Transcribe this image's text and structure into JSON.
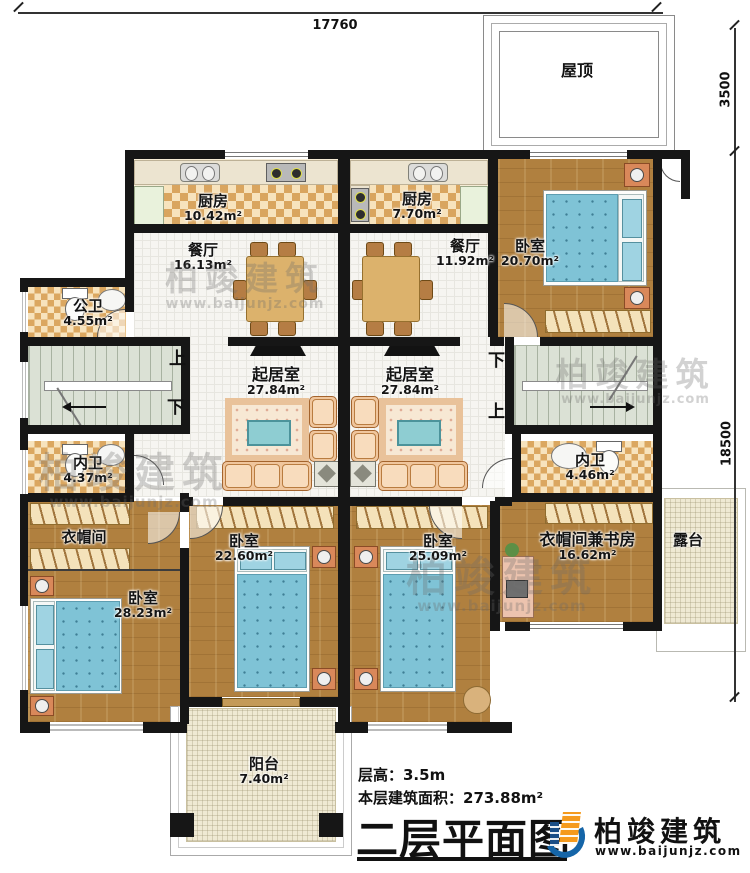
{
  "dimensions": {
    "top": "17760",
    "right_upper": "3500",
    "right_lower": "18500"
  },
  "stairs": {
    "left": {
      "top": "上",
      "bottom": "下"
    },
    "right": {
      "top": "下",
      "bottom": "上"
    }
  },
  "rooms": [
    {
      "name": "厨房",
      "area": "10.42m²"
    },
    {
      "name": "餐厅",
      "area": "16.13m²"
    },
    {
      "name": "公卫",
      "area": "4.55m²"
    },
    {
      "name": "内卫",
      "area": "4.37m²"
    },
    {
      "name": "衣帽间",
      "area": ""
    },
    {
      "name": "卧室",
      "area": "28.23m²"
    },
    {
      "name": "起居室",
      "area": "27.84m²"
    },
    {
      "name": "卧室",
      "area": "22.60m²"
    },
    {
      "name": "厨房",
      "area": "7.70m²"
    },
    {
      "name": "餐厅",
      "area": "11.92m²"
    },
    {
      "name": "卧室",
      "area": "20.70m²"
    },
    {
      "name": "起居室",
      "area": "27.84m²"
    },
    {
      "name": "内卫",
      "area": "4.46m²"
    },
    {
      "name": "卧室",
      "area": "25.09m²"
    },
    {
      "name": "衣帽间兼书房",
      "area": "16.62m²"
    },
    {
      "name": "露台",
      "area": ""
    },
    {
      "name": "阳台",
      "area": "7.40m²"
    },
    {
      "name": "屋顶",
      "area": ""
    }
  ],
  "info": {
    "floor_height": "层高：3.5m",
    "floor_area": "本层建筑面积：273.88m²",
    "plan_title": "二层平面图"
  },
  "logo": {
    "name": "柏竣建筑",
    "url": "www.baijunjz.com"
  },
  "watermark": {
    "text": "柏竣建筑",
    "url": "www.baijunjz.com"
  }
}
